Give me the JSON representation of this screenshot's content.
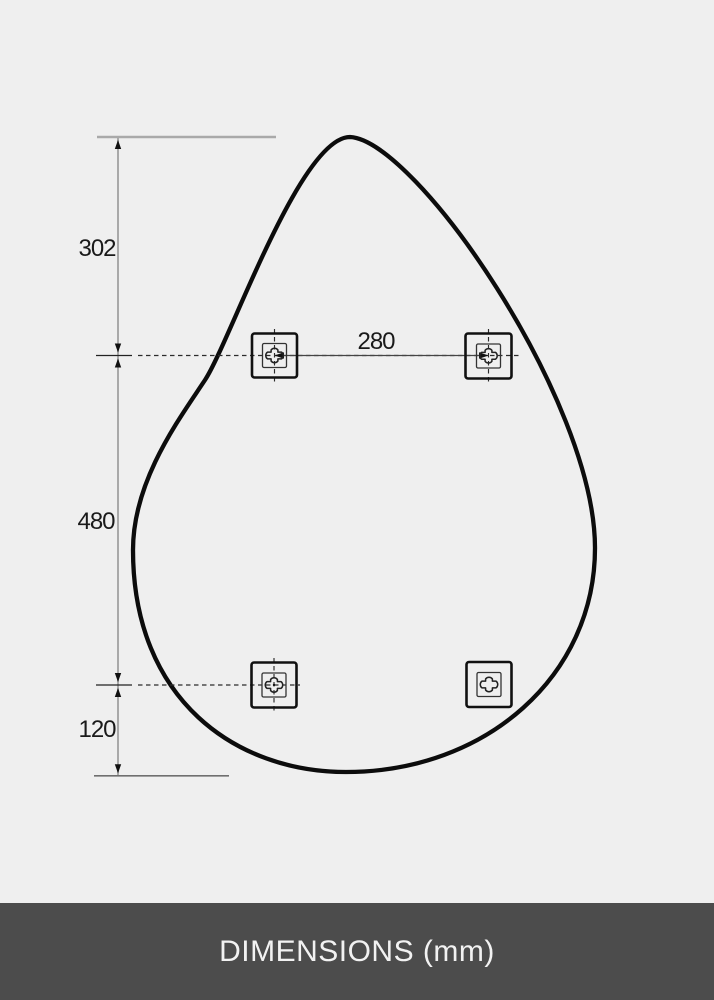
{
  "diagram": {
    "vertical_dimensions": [
      {
        "label": "302"
      },
      {
        "label": "480"
      },
      {
        "label": "120"
      }
    ],
    "horizontal_dimension": {
      "label": "280"
    },
    "brackets": {
      "icon": "cross-screw-slot-icon",
      "count": 4,
      "positions": [
        "top-left",
        "top-right",
        "bottom-left",
        "bottom-right"
      ]
    }
  },
  "footer": {
    "title": "DIMENSIONS (mm)"
  },
  "colors": {
    "background": "#efefef",
    "outline": "#0c0c0c",
    "extension_gray": "#a9a9a9",
    "dimension_dark": "#222222",
    "footer_bg": "#4c4c4c",
    "footer_text": "#f2f2f2"
  }
}
